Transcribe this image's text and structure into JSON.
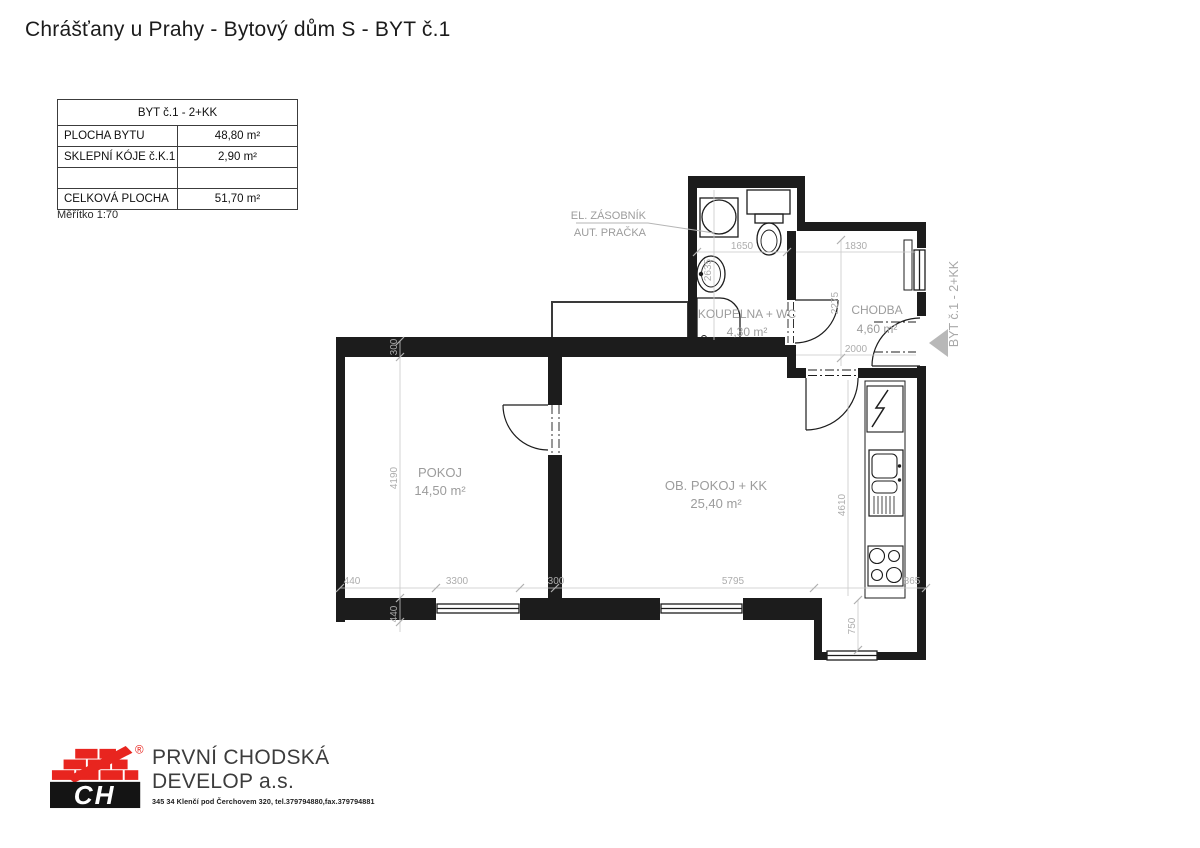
{
  "page": {
    "title": "Chrášťany u Prahy - Bytový dům S - BYT č.1"
  },
  "info_table": {
    "header": "BYT č.1 - 2+KK",
    "rows": [
      {
        "label": "PLOCHA BYTU",
        "value": "48,80 m²"
      },
      {
        "label": "SKLEPNÍ KÓJE č.K.1",
        "value": "2,90 m²"
      },
      {
        "label": "",
        "value": ""
      },
      {
        "label": "CELKOVÁ PLOCHA",
        "value": "51,70 m²"
      }
    ],
    "scale_note": "Měřítko 1:70"
  },
  "floorplan": {
    "rooms": {
      "pokoj": {
        "name": "POKOJ",
        "area": "14,50 m²"
      },
      "obpokoj": {
        "name": "OB. POKOJ + KK",
        "area": "25,40 m²"
      },
      "koupelna": {
        "name": "KOUPELNA + WC",
        "area": "4,30 m²"
      },
      "chodba": {
        "name": "CHODBA",
        "area": "4,60 m²"
      }
    },
    "annotations": {
      "el_zasobnik": "EL. ZÁSOBNÍK",
      "aut_pracka": "AUT. PRAČKA"
    },
    "entrance_label": "BYT č.1 - 2+KK",
    "dimensions": {
      "top_wall": "300",
      "pokoj_height": "4190",
      "left_offset": "440",
      "pokoj_width": "3300",
      "partition": "300",
      "pokoj_sill": "440",
      "obpokoj_width": "5795",
      "obpokoj_height": "4610",
      "koupelna_width": "1650",
      "koupelna_height": "2635",
      "chodba_width": "1830",
      "chodba_height": "2275",
      "chodba_bottom": "2000",
      "niche_height": "750",
      "niche_width": "865"
    }
  },
  "footer": {
    "logo_letters": "CH",
    "registered_mark": "®",
    "company_line1": "PRVNÍ CHODSKÁ",
    "company_line2": "DEVELOP a.s.",
    "address": "345 34 Klenčí pod Čerchovem 320, tel.379794880,fax.379794881"
  }
}
